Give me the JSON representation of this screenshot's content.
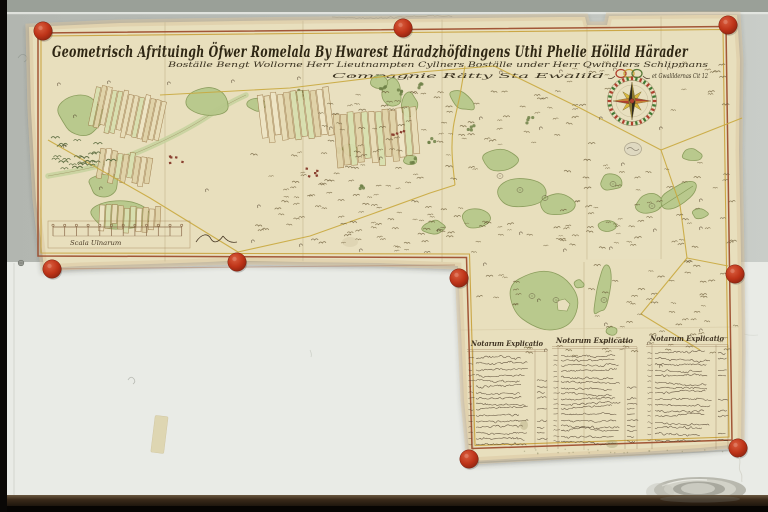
{
  "scene": {
    "description": "Photograph of a 17th-century Swedish geometric cadastral map, assembled from several joined sheets, pinned to a pale wall with round red wax seals above a dark table edge",
    "pin_count": 9
  },
  "map": {
    "title_line1": "Geometrisch Afrituingh Öfwer Romelala By Hwarest Häradzhöfdingens Uthi Phelie Hölild Härader",
    "title_line2": "Boställe Bengt Wollorne Herr Lieutnampten Cyllners Boställe under Herr Qwindlers Schlipmans",
    "title_line3a": "Compagnie Rätty Sta Ewalild",
    "title_line3b": "et Gwalildernas Cit 12",
    "scale_label": "Scala Ulnarum",
    "tables": [
      {
        "header": "Notarum Explicatio",
        "row_count": 16
      },
      {
        "header": "Notarum Explicatio",
        "row_count": 17
      },
      {
        "header": "Notarum Explicatio",
        "row_count": 16
      }
    ]
  },
  "colors": {
    "paper": "#e8dfbd",
    "paper_margin": "#e3d2ae",
    "border_outer": "#9b4a2b",
    "border_inner": "#c8a23c",
    "green": "#b7c88b",
    "green_edge": "#879a58",
    "green_dark": "#55663a",
    "boundary": "#c9a83e",
    "ink": "#4a3a26",
    "ink_dark": "#2f2714",
    "pin": "#bf3a1d",
    "wall_top": "#9aa098",
    "wall": "#b9bdb7",
    "wall_right": "#c9cdc8",
    "whiteboard": "#e9ebe6",
    "table_strip": "#241810",
    "film_black": "#0a0806",
    "tape": "#ddd4ad",
    "metal": "#c2c2b8"
  }
}
